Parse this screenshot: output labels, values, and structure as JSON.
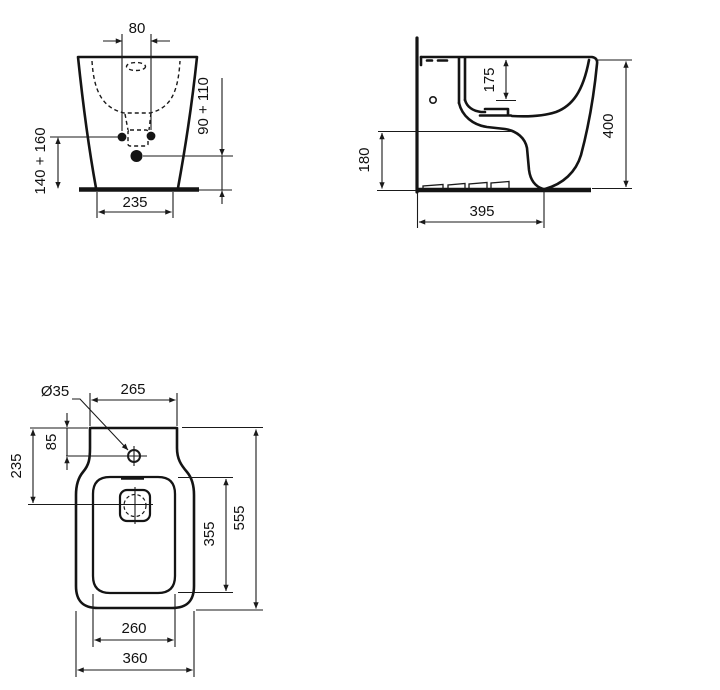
{
  "front_view": {
    "tap_holes_spacing": "80",
    "fixing_height_range": "140 + 160",
    "inlet_height_range": "90 + 110",
    "base_width": "235"
  },
  "side_view": {
    "bowl_depth": "175",
    "inlet_height": "180",
    "overall_height": "400",
    "overall_depth": "395"
  },
  "plan_view": {
    "tap_hole_diameter": "Ø35",
    "back_width": "265",
    "tap_hole_offset": "85",
    "drain_offset": "235",
    "bowl_length": "355",
    "overall_length": "555",
    "bowl_width": "260",
    "overall_width": "360"
  },
  "colors": {
    "line": "#141414",
    "background": "#ffffff"
  }
}
